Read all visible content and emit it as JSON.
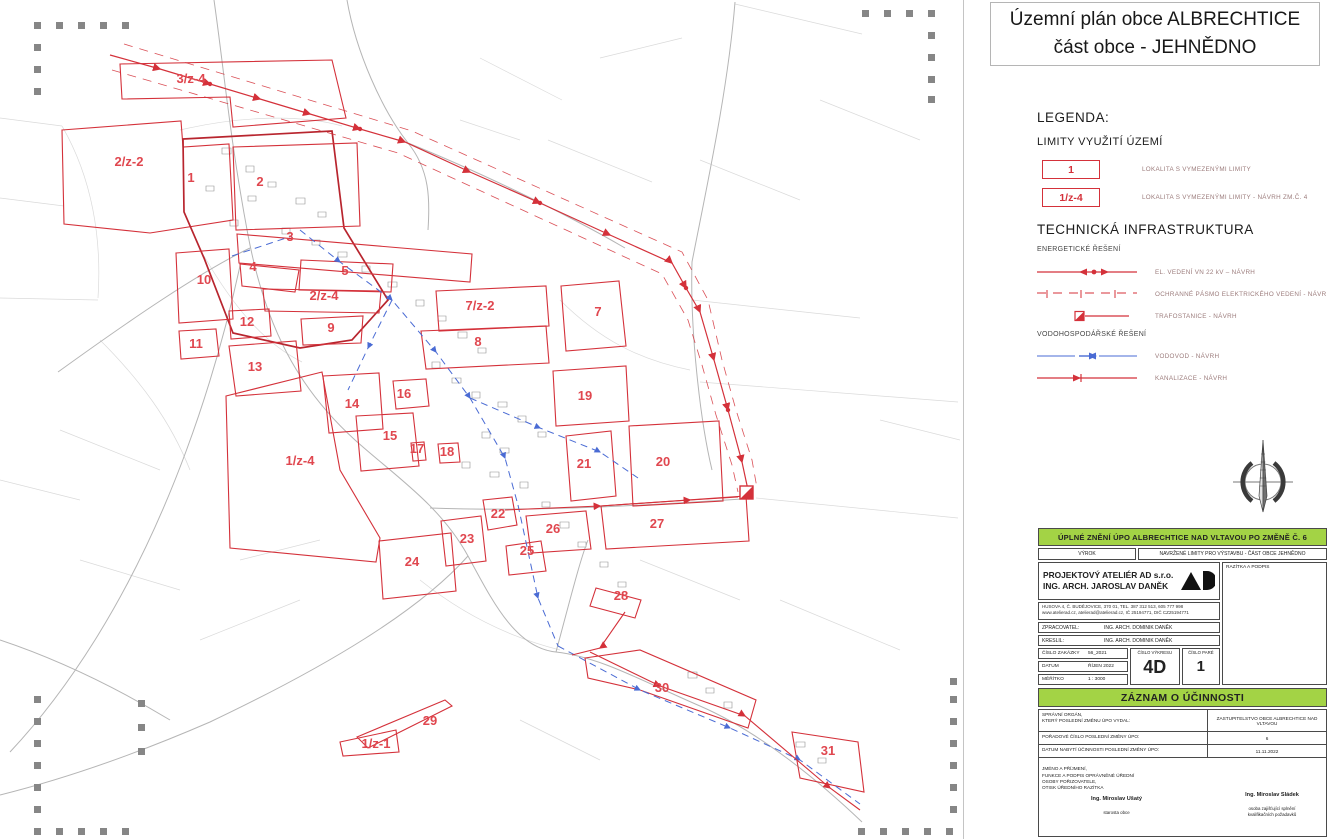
{
  "title": {
    "line1": "Územní plán obce ALBRECHTICE",
    "line2": "část obce - JEHNĚDNO"
  },
  "legend": {
    "heading": "LEGENDA:",
    "limits": {
      "heading": "LIMITY VYUŽITÍ ÚZEMÍ",
      "items": [
        {
          "symbol": "1",
          "label": "LOKALITA S VYMEZENÝMI LIMITY"
        },
        {
          "symbol": "1/z-4",
          "label": "LOKALITA S VYMEZENÝMI LIMITY - NÁVRH ZM.Č. 4"
        }
      ]
    },
    "infra": {
      "heading": "TECHNICKÁ INFRASTRUKTURA",
      "energy": {
        "heading": "ENERGETICKÉ ŘEŠENÍ",
        "items": [
          {
            "label": "EL. VEDENÍ VN 22 kV – NÁVRH"
          },
          {
            "label": "OCHRANNÉ PÁSMO ELEKTRICKÉHO VEDENÍ - NÁVRH"
          },
          {
            "label": "TRAFOSTANICE - NÁVRH"
          }
        ]
      },
      "water": {
        "heading": "VODOHOSPODÁŘSKÉ ŘEŠENÍ",
        "items": [
          {
            "label": "VODOVOD - NÁVRH"
          },
          {
            "label": "KANALIZACE - NÁVRH"
          }
        ]
      }
    }
  },
  "map": {
    "zones": [
      {
        "id": "3/z-4",
        "x": 191,
        "y": 83
      },
      {
        "id": "2/z-2",
        "x": 129,
        "y": 166
      },
      {
        "id": "1",
        "x": 191,
        "y": 182
      },
      {
        "id": "2",
        "x": 260,
        "y": 186
      },
      {
        "id": "3",
        "x": 290,
        "y": 241
      },
      {
        "id": "4",
        "x": 253,
        "y": 271
      },
      {
        "id": "5",
        "x": 345,
        "y": 275
      },
      {
        "id": "10",
        "x": 204,
        "y": 284
      },
      {
        "id": "2/z-4",
        "x": 324,
        "y": 300
      },
      {
        "id": "7/z-2",
        "x": 480,
        "y": 310
      },
      {
        "id": "7",
        "x": 598,
        "y": 316
      },
      {
        "id": "12",
        "x": 247,
        "y": 326
      },
      {
        "id": "9",
        "x": 331,
        "y": 332
      },
      {
        "id": "8",
        "x": 478,
        "y": 346
      },
      {
        "id": "11",
        "x": 196,
        "y": 348
      },
      {
        "id": "13",
        "x": 255,
        "y": 371
      },
      {
        "id": "16",
        "x": 404,
        "y": 398
      },
      {
        "id": "14",
        "x": 352,
        "y": 408
      },
      {
        "id": "19",
        "x": 585,
        "y": 400
      },
      {
        "id": "15",
        "x": 390,
        "y": 440
      },
      {
        "id": "17",
        "x": 417,
        "y": 453
      },
      {
        "id": "18",
        "x": 447,
        "y": 456
      },
      {
        "id": "1/z-4",
        "x": 300,
        "y": 465
      },
      {
        "id": "21",
        "x": 584,
        "y": 468
      },
      {
        "id": "20",
        "x": 663,
        "y": 466
      },
      {
        "id": "22",
        "x": 498,
        "y": 518
      },
      {
        "id": "26",
        "x": 553,
        "y": 533
      },
      {
        "id": "27",
        "x": 657,
        "y": 528
      },
      {
        "id": "23",
        "x": 467,
        "y": 543
      },
      {
        "id": "25",
        "x": 527,
        "y": 555
      },
      {
        "id": "24",
        "x": 412,
        "y": 566
      },
      {
        "id": "28",
        "x": 621,
        "y": 600
      },
      {
        "id": "30",
        "x": 662,
        "y": 692
      },
      {
        "id": "29",
        "x": 430,
        "y": 725
      },
      {
        "id": "1/z-1",
        "x": 376,
        "y": 748
      },
      {
        "id": "31",
        "x": 828,
        "y": 755
      }
    ]
  },
  "titleblock": {
    "header": "ÚPLNÉ ZNĚNÍ ÚPO ALBRECHTICE NAD VLTAVOU PO ZMĚNĚ Č. 6",
    "vyrok_label": "VÝROK",
    "vyrok_value": "NAVRŽENÉ LIMITY PRO VÝSTAVBU - ČÁST OBCE JEHNĚDNO",
    "studio_line1": "PROJEKTOVÝ ATELIÉR AD s.r.o.",
    "studio_line2": "ING. ARCH. JAROSLAV DANĚK",
    "stamp_label": "RAZÍTKA A PODPIS",
    "address_line1": "HUSOVA 4, Č. BUDĚJOVICE, 370 01, TEL. 387 312 513, 605 777 998",
    "address_line2": "www.atelierad.cz, atelierad@atelierad.cz, IČ 25194771, DIČ CZ25194771",
    "zpracovatel_label": "ZPRACOVATEL:",
    "zpracovatel_value": "ING. ARCH. DOMINIK DANĚK",
    "kreslil_label": "KRESLIL:",
    "kreslil_value": "ING. ARCH. DOMINIK DANĚK",
    "zakazka_label": "ČÍSLO ZAKÁZKY",
    "zakazka_value": "56_2021",
    "datum_label": "DATUM",
    "datum_value": "ŘÍJEN 2022",
    "meritko_label": "MĚŘÍTKO",
    "meritko_value": "1 : 3000",
    "cislo_vykresu_label": "ČÍSLO VÝKRESU",
    "cislo_vykresu_value": "4D",
    "cislo_pare_label": "ČÍSLO PARÉ",
    "cislo_pare_value": "1"
  },
  "zaznam": {
    "header": "ZÁZNAM O ÚČINNOSTI",
    "rows": [
      {
        "label": "SPRÁVNÍ ORGÁN,\nKTERÝ POSLEDNÍ ZMĚNU ÚPO VYDAL:",
        "value": "ZASTUPITELSTVO OBCE ALBRECHTICE NAD VLTAVOU"
      },
      {
        "label": "POŘADOVÉ ČÍSLO POSLEDNÍ ZMĚNY ÚPO:",
        "value": "6"
      },
      {
        "label": "DATUM NABYTÍ ÚČINNOSTI POSLEDNÍ ZMĚNY ÚPO:",
        "value": "11.11.2022"
      }
    ],
    "note": "JMÉNO A PŘÍJMENÍ,\nFUNKCE A PODPIS OPRÁVNĚNÉ ÚŘEDNÍ\nOSOBY POŘIZOVATELE,\nOTISK ÚŘEDNÍHO RAZÍTKA",
    "signatures": [
      {
        "name": "Ing. Miroslav Ušatý",
        "role": "starosta obce"
      },
      {
        "name": "Ing. Miroslav Sládek",
        "role": "osoba zajišťující splnění\nkvalifikačních požadavků"
      }
    ]
  },
  "colors": {
    "red": "#d4313a",
    "labelred": "#e0474f",
    "blue": "#4a6bd4",
    "green": "#a3d345"
  }
}
